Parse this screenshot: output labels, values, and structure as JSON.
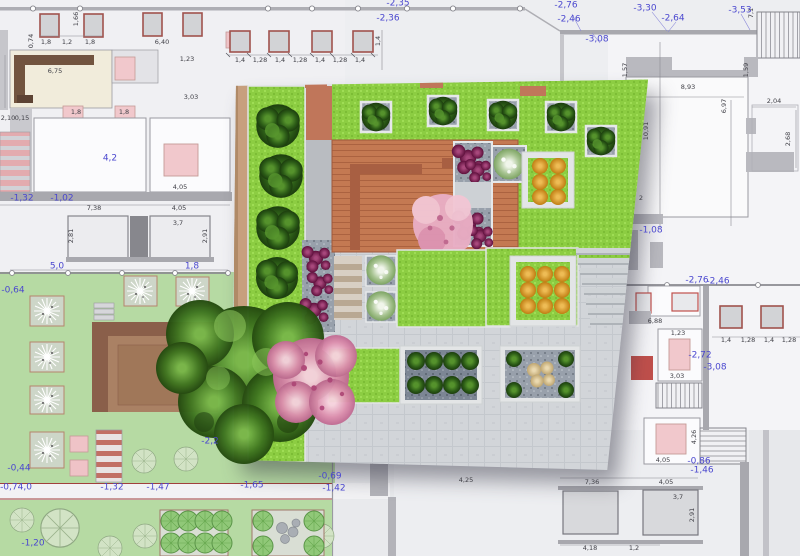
{
  "document": {
    "type": "landscape-architecture plan",
    "description": "CAD site and floor plan with a 3D rendered roof-garden visualization overlaid in the center"
  },
  "colors": {
    "cad_background": "#edeef1",
    "wall_gray": "#a8a8ae",
    "elevation_blue": "#4a47cf",
    "dimension_text": "#3e3e45",
    "garden_green_2d": "#b6daa3",
    "render_lawn_green": "#8ccd42",
    "deck_terracotta": "#c47952",
    "pink_furniture": "#f1c8cc",
    "red_accent": "#bf4f4b",
    "orange_plant": "#d09020",
    "purple_plant": "#7c2050",
    "blossom_pink": "#e9aec4"
  },
  "elevation_labels": [
    {
      "t": "-2,76",
      "x": 566,
      "y": 6
    },
    {
      "t": "-2,46",
      "x": 569,
      "y": 20
    },
    {
      "t": "-3,08",
      "x": 597,
      "y": 40
    },
    {
      "t": "-3,30",
      "x": 645,
      "y": 9
    },
    {
      "t": "-2,64",
      "x": 673,
      "y": 19
    },
    {
      "t": "-3,53",
      "x": 740,
      "y": 11
    },
    {
      "t": "-2,35",
      "x": 398,
      "y": 4
    },
    {
      "t": "-2,36",
      "x": 388,
      "y": 19
    },
    {
      "t": "-1,08",
      "x": 651,
      "y": 231
    },
    {
      "t": "4,2",
      "x": 110,
      "y": 159
    },
    {
      "t": "-1,32",
      "x": 22,
      "y": 199
    },
    {
      "t": "-1,02",
      "x": 62,
      "y": 199
    },
    {
      "t": "-0,64",
      "x": 13,
      "y": 291
    },
    {
      "t": "5,0",
      "x": 57,
      "y": 267
    },
    {
      "t": "1,8",
      "x": 192,
      "y": 267
    },
    {
      "t": "-0,44",
      "x": 19,
      "y": 469
    },
    {
      "t": "-0,74,0",
      "x": 16,
      "y": 488
    },
    {
      "t": "-1,32",
      "x": 112,
      "y": 488
    },
    {
      "t": "-1,47",
      "x": 158,
      "y": 488
    },
    {
      "t": "-2,2",
      "x": 210,
      "y": 442
    },
    {
      "t": "-1,20",
      "x": 33,
      "y": 544
    },
    {
      "t": "-1,65",
      "x": 252,
      "y": 486
    },
    {
      "t": "-0,69",
      "x": 330,
      "y": 477
    },
    {
      "t": "-1,42",
      "x": 334,
      "y": 489
    },
    {
      "t": "-0,86",
      "x": 699,
      "y": 462
    },
    {
      "t": "-1,46",
      "x": 702,
      "y": 471
    },
    {
      "t": "-2,76",
      "x": 697,
      "y": 281
    },
    {
      "t": "-2,46",
      "x": 718,
      "y": 282
    },
    {
      "t": "-2,72",
      "x": 700,
      "y": 356
    },
    {
      "t": "-3,08",
      "x": 715,
      "y": 368
    }
  ],
  "dimension_labels": [
    {
      "t": "7,1",
      "x": 751,
      "y": 13,
      "r": 1
    },
    {
      "t": "1,57",
      "x": 625,
      "y": 70,
      "r": 1
    },
    {
      "t": "1,59",
      "x": 746,
      "y": 70,
      "r": 1
    },
    {
      "t": "8,93",
      "x": 688,
      "y": 87
    },
    {
      "t": "6,97",
      "x": 724,
      "y": 106,
      "r": 1
    },
    {
      "t": "2,04",
      "x": 774,
      "y": 101
    },
    {
      "t": "2,68",
      "x": 788,
      "y": 139,
      "r": 1
    },
    {
      "t": "10,91",
      "x": 646,
      "y": 131,
      "r": 1
    },
    {
      "t": "2",
      "x": 641,
      "y": 198
    },
    {
      "t": "1,4",
      "x": 240,
      "y": 60
    },
    {
      "t": "1,28",
      "x": 260,
      "y": 60
    },
    {
      "t": "1,4",
      "x": 280,
      "y": 60
    },
    {
      "t": "1,28",
      "x": 300,
      "y": 60
    },
    {
      "t": "1,4",
      "x": 320,
      "y": 60
    },
    {
      "t": "1,28",
      "x": 340,
      "y": 60
    },
    {
      "t": "1,4",
      "x": 360,
      "y": 60
    },
    {
      "t": "1,4",
      "x": 378,
      "y": 41,
      "r": 1
    },
    {
      "t": "1,8",
      "x": 46,
      "y": 42
    },
    {
      "t": "1,2",
      "x": 67,
      "y": 42
    },
    {
      "t": "1,8",
      "x": 90,
      "y": 42
    },
    {
      "t": "6,40",
      "x": 162,
      "y": 42
    },
    {
      "t": "0,74",
      "x": 31,
      "y": 41,
      "r": 1
    },
    {
      "t": "1,66",
      "x": 76,
      "y": 19,
      "r": 1
    },
    {
      "t": "1,23",
      "x": 187,
      "y": 59
    },
    {
      "t": "3,03",
      "x": 191,
      "y": 97
    },
    {
      "t": "6,75",
      "x": 55,
      "y": 71
    },
    {
      "t": "2,10",
      "x": 8,
      "y": 118
    },
    {
      "t": "0,15",
      "x": 22,
      "y": 118
    },
    {
      "t": "1,8",
      "x": 76,
      "y": 112
    },
    {
      "t": "1,8",
      "x": 124,
      "y": 112
    },
    {
      "t": "7,38",
      "x": 94,
      "y": 208
    },
    {
      "t": "4,05",
      "x": 179,
      "y": 208
    },
    {
      "t": "4,05",
      "x": 180,
      "y": 187
    },
    {
      "t": "3,7",
      "x": 178,
      "y": 223
    },
    {
      "t": "2,81",
      "x": 71,
      "y": 236,
      "r": 1
    },
    {
      "t": "2,91",
      "x": 205,
      "y": 236,
      "r": 1
    },
    {
      "t": "1,4",
      "x": 726,
      "y": 340
    },
    {
      "t": "1,28",
      "x": 748,
      "y": 340
    },
    {
      "t": "1,4",
      "x": 769,
      "y": 340
    },
    {
      "t": "1,28",
      "x": 789,
      "y": 340
    },
    {
      "t": "1,23",
      "x": 678,
      "y": 333
    },
    {
      "t": "3,03",
      "x": 677,
      "y": 376
    },
    {
      "t": "6,88",
      "x": 655,
      "y": 321
    },
    {
      "t": "7,36",
      "x": 592,
      "y": 482
    },
    {
      "t": "4,05",
      "x": 666,
      "y": 482
    },
    {
      "t": "4,05",
      "x": 663,
      "y": 460
    },
    {
      "t": "4,26",
      "x": 694,
      "y": 437,
      "r": 1
    },
    {
      "t": "3,7",
      "x": 678,
      "y": 497
    },
    {
      "t": "2,91",
      "x": 692,
      "y": 515,
      "r": 1
    },
    {
      "t": "4,18",
      "x": 590,
      "y": 548
    },
    {
      "t": "1,2",
      "x": 634,
      "y": 548
    },
    {
      "t": "4,25",
      "x": 466,
      "y": 480
    }
  ],
  "render_features": [
    "lawn",
    "boxwood-shrubs",
    "terracotta-deck",
    "bench",
    "gravel-planters",
    "purple-perennials",
    "pink-flowering-tree",
    "orange-shrub-planter",
    "white-flowering-shrubs",
    "stone-steps",
    "paved-terrace",
    "timber-screen-wall",
    "large-deciduous-tree"
  ]
}
